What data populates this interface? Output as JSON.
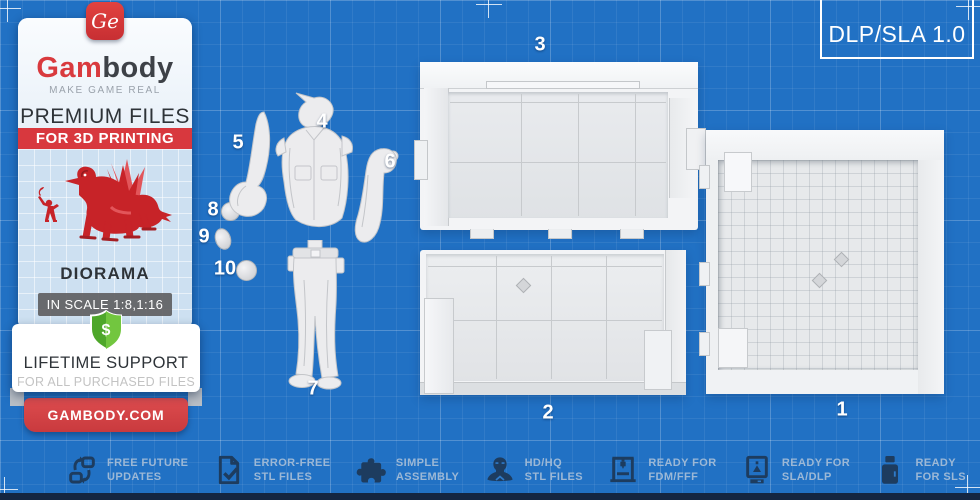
{
  "badge": {
    "label": "DLP/SLA 1.0"
  },
  "brand": {
    "monogram": "Ge",
    "name_red": "Gam",
    "name_dark": "body",
    "tagline": "MAKE GAME REAL",
    "premium_line": "PREMIUM FILES",
    "printing_line": "FOR 3D PRINTING",
    "category": "DIORAMA",
    "scale": "IN SCALE 1:8,1:16",
    "shield_symbol": "$",
    "support_title": "LIFETIME SUPPORT",
    "support_sub": "FOR ALL PURCHASED FILES",
    "website": "GAMBODY.COM"
  },
  "part_numbers": [
    "1",
    "2",
    "3",
    "4",
    "5",
    "6",
    "7",
    "8",
    "9",
    "10"
  ],
  "features": [
    {
      "icon": "refresh-icon",
      "line1": "FREE FUTURE",
      "line2": "UPDATES"
    },
    {
      "icon": "document-check-icon",
      "line1": "ERROR-FREE",
      "line2": "STL FILES"
    },
    {
      "icon": "puzzle-icon",
      "line1": "SIMPLE",
      "line2": "ASSEMBLY"
    },
    {
      "icon": "bust-icon",
      "line1": "HD/HQ",
      "line2": "STL FILES"
    },
    {
      "icon": "fdm-printer-icon",
      "line1": "READY FOR",
      "line2": "FDM/FFF"
    },
    {
      "icon": "sla-printer-icon",
      "line1": "READY FOR",
      "line2": "SLA/DLP"
    },
    {
      "icon": "sls-printer-icon",
      "line1": "READY",
      "line2": "FOR SLS"
    }
  ],
  "colors": {
    "blueprint_blue": "#2171c4",
    "brand_red": "#d8383e",
    "icon_navy": "#1d3c5f",
    "feature_text": "#9cb8d6",
    "shield_green": "#56b32f"
  }
}
